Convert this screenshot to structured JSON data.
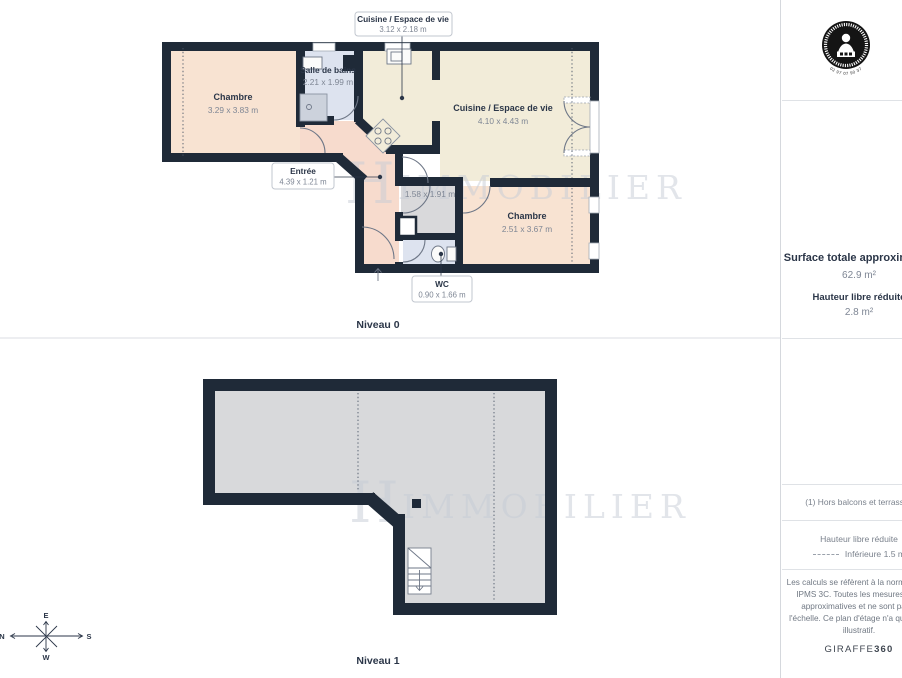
{
  "colors": {
    "wall": "#1f2a38",
    "peach": "#f8e3d2",
    "cream": "#f2ecd9",
    "blue": "#dde3ef",
    "pink": "#f7dbcd",
    "grey": "#d9d9db",
    "floor1": "#d8d9db",
    "navy": "#2b3648",
    "tgrey": "#7e8694",
    "line": "#6e7787",
    "divider": "#dfe2e6",
    "wmk": "#c6ccd6"
  },
  "watermark": {
    "initial": "H",
    "word": "IMMOBILIER"
  },
  "compass": {
    "n": "N",
    "e": "E",
    "s": "S",
    "w": "W"
  },
  "plans": {
    "level0": {
      "name": "Niveau 0",
      "rooms": {
        "chambre1": {
          "name": "Chambre",
          "dims": "3.29 x 3.83 m"
        },
        "salle_de_bains": {
          "name": "Salle de bains",
          "dims": "2.21 x 1.99 m"
        },
        "cuisine": {
          "name": "Cuisine / Espace de vie",
          "dims": "4.10 x 4.43 m"
        },
        "petite_piece": {
          "dims": "1.58 x 1.91 m"
        },
        "chambre2": {
          "name": "Chambre",
          "dims": "2.51 x 3.67 m"
        }
      },
      "callouts": {
        "cuisine_haut": {
          "title": "Cuisine / Espace de vie",
          "dims": "3.12 x 2.18 m"
        },
        "entree": {
          "title": "Entrée",
          "dims": "4.39 x 1.21 m"
        },
        "wc": {
          "title": "WC",
          "dims": "0.90 x 1.66 m"
        }
      }
    },
    "level1": {
      "name": "Niveau 1"
    }
  },
  "sidebar": {
    "surface_title": "Surface totale approximative",
    "surface_value": "62.9 m²",
    "hauteur_title": "Hauteur libre réduite",
    "hauteur_value": "2.8 m²",
    "footnote": "(1) Hors balcons et terrasses",
    "legend_title": "Hauteur libre réduite",
    "legend_value": "Inférieure 1.5 m",
    "disclaimer": [
      "Les calculs se réfèrent à la norme RICS",
      "IPMS 3C. Toutes les mesures sont",
      "approximatives et ne sont pas à",
      "l'échelle. Ce plan d'étage n'a qu'un but",
      "illustratif."
    ],
    "brand": {
      "name": "GIRAFFE",
      "suffix": "360"
    },
    "logo_phone": "02 97 07 90 37"
  }
}
